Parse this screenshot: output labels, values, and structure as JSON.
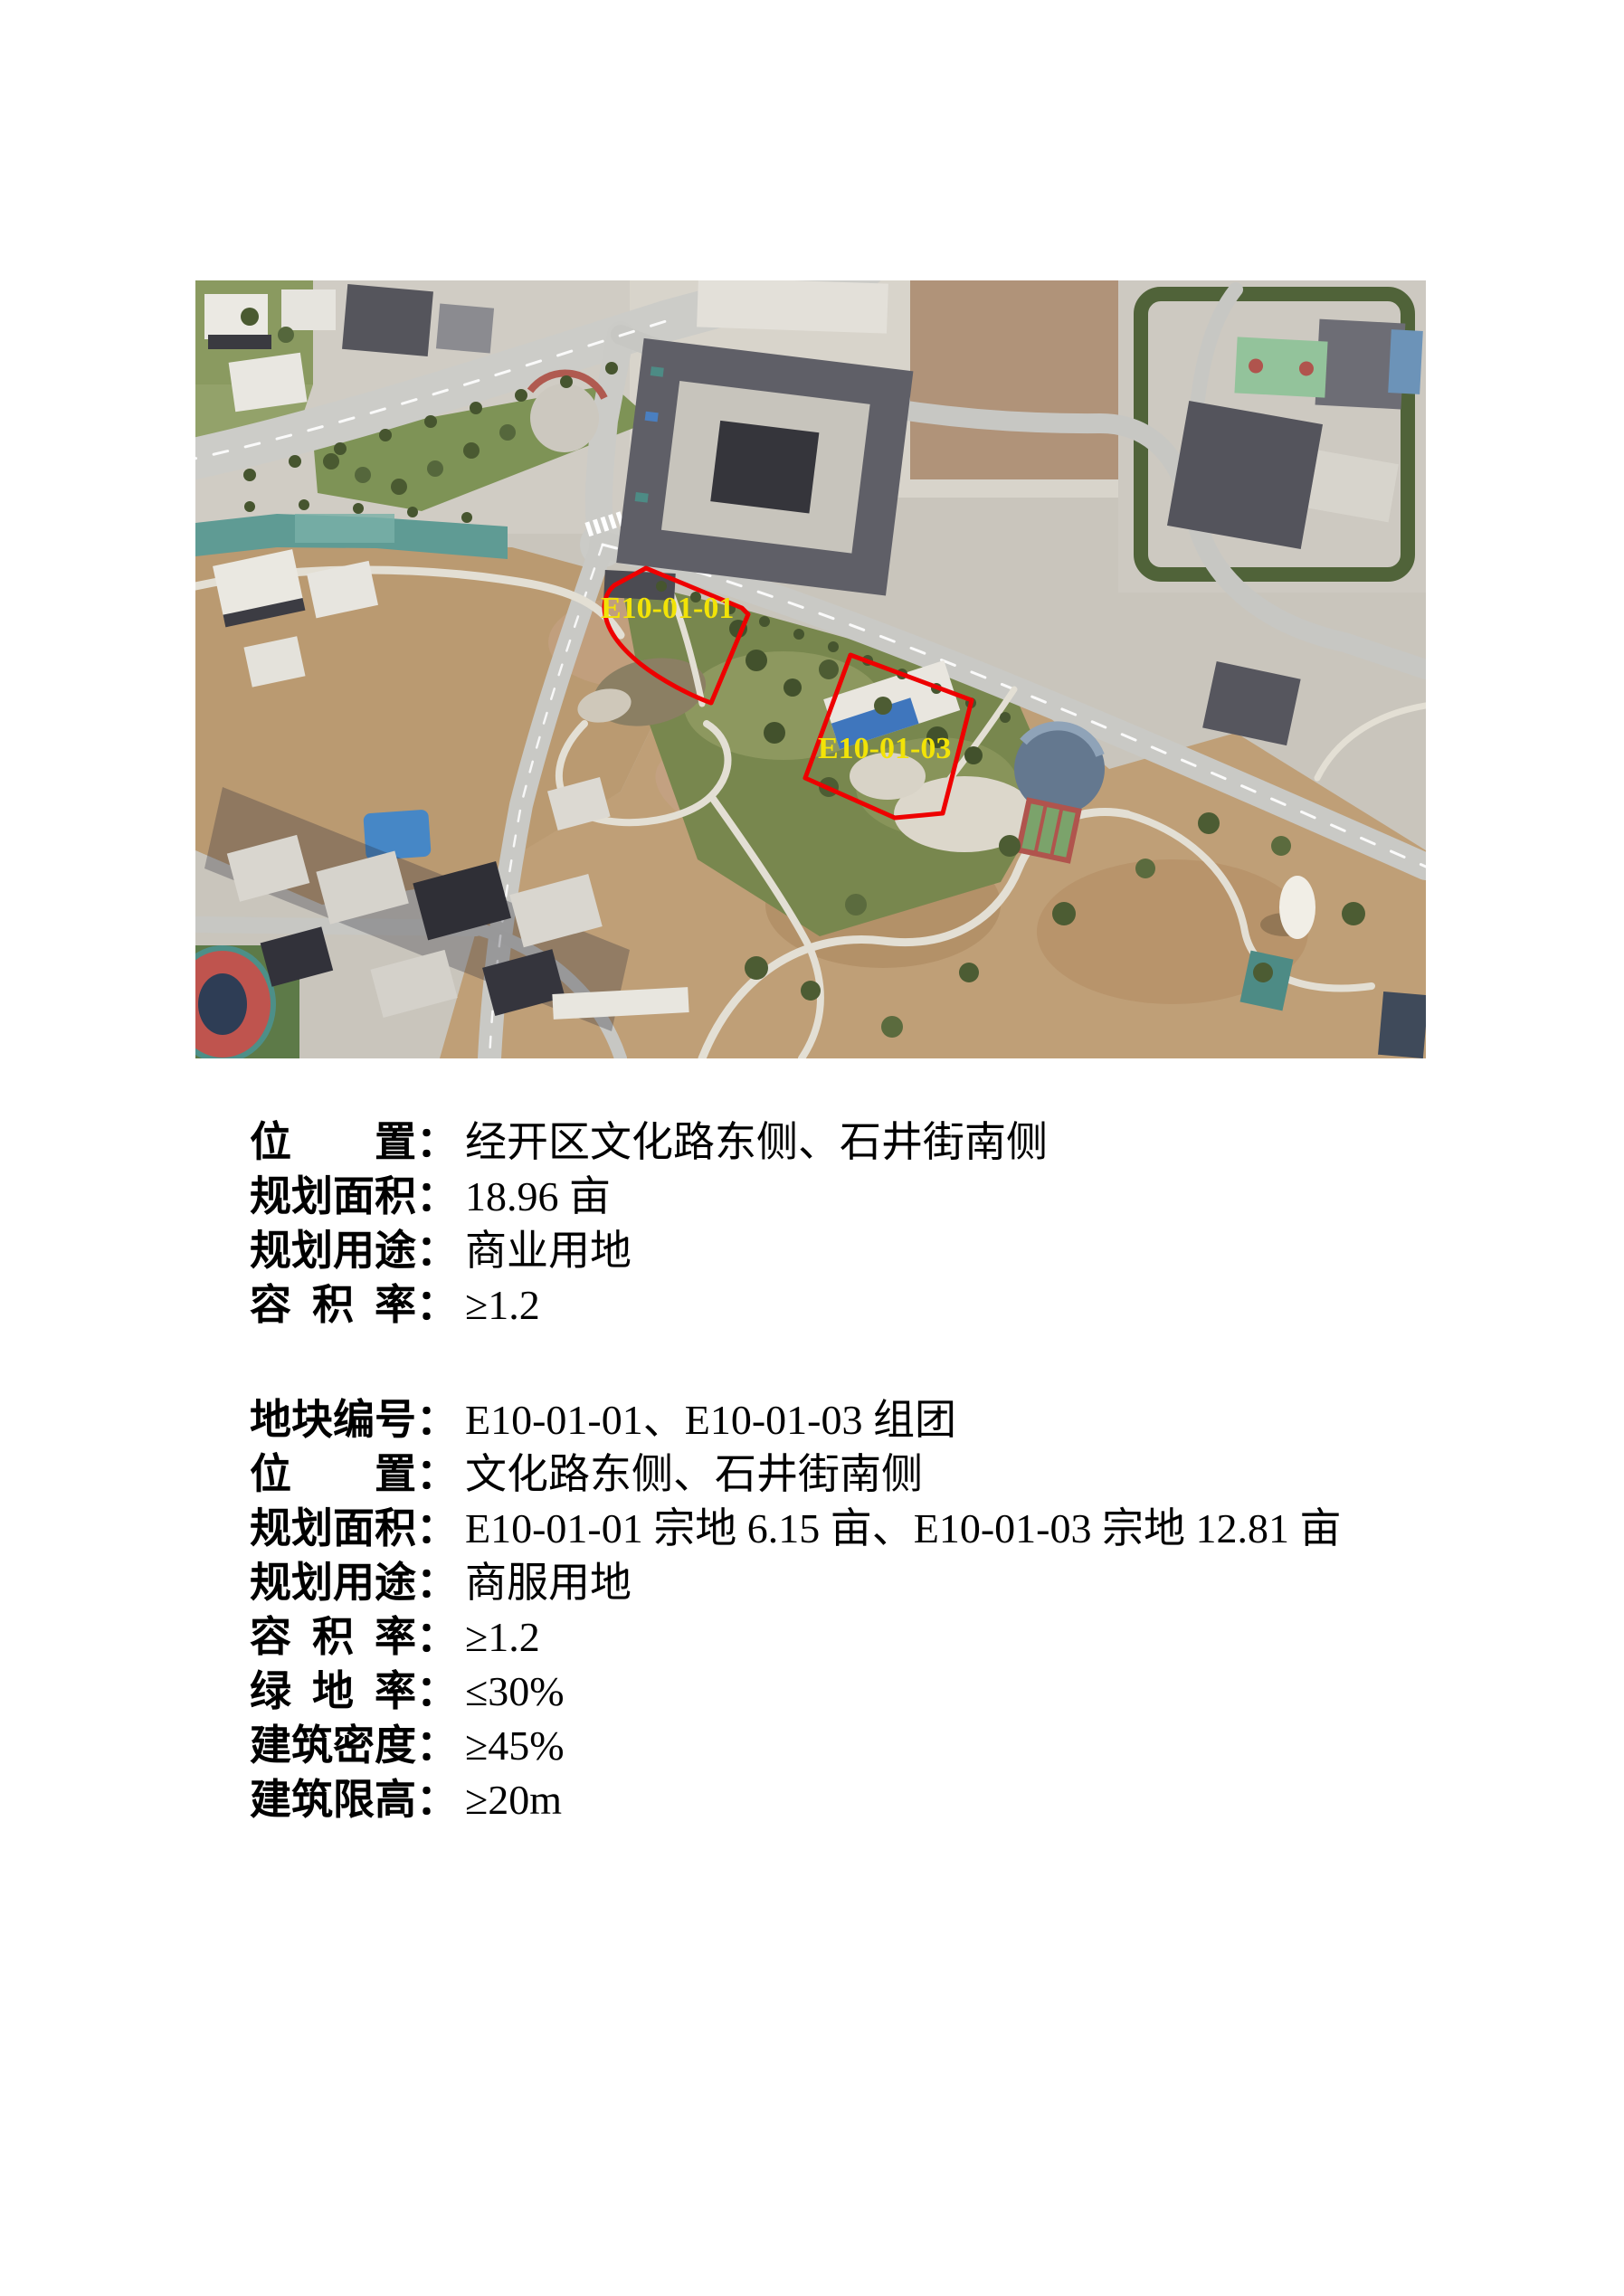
{
  "photo": {
    "parcels": [
      {
        "label": "E10-01-01"
      },
      {
        "label": "E10-01-03"
      }
    ],
    "outline_color": "#ee0000",
    "label_color": "#f2e307"
  },
  "text": {
    "colon": "："
  },
  "block1": {
    "rows": [
      {
        "label": "位置",
        "value": "经开区文化路东侧、石井街南侧"
      },
      {
        "label": "规划面积",
        "value": "18.96 亩"
      },
      {
        "label": "规划用途",
        "value": "商业用地"
      },
      {
        "label": "容积率",
        "value": "≥1.2"
      }
    ]
  },
  "block2": {
    "rows": [
      {
        "label": "地块编号",
        "value": "E10-01-01、E10-01-03 组团"
      },
      {
        "label": "位置",
        "value": "文化路东侧、石井街南侧"
      },
      {
        "label": "规划面积",
        "value": "E10-01-01 宗地 6.15 亩、E10-01-03 宗地 12.81 亩"
      },
      {
        "label": "规划用途",
        "value": "商服用地"
      },
      {
        "label": "容积率",
        "value": "≥1.2"
      },
      {
        "label": "绿地率",
        "value": "≤30%"
      },
      {
        "label": "建筑密度",
        "value": "≥45%"
      },
      {
        "label": "建筑限高",
        "value": "≥20m"
      }
    ]
  }
}
